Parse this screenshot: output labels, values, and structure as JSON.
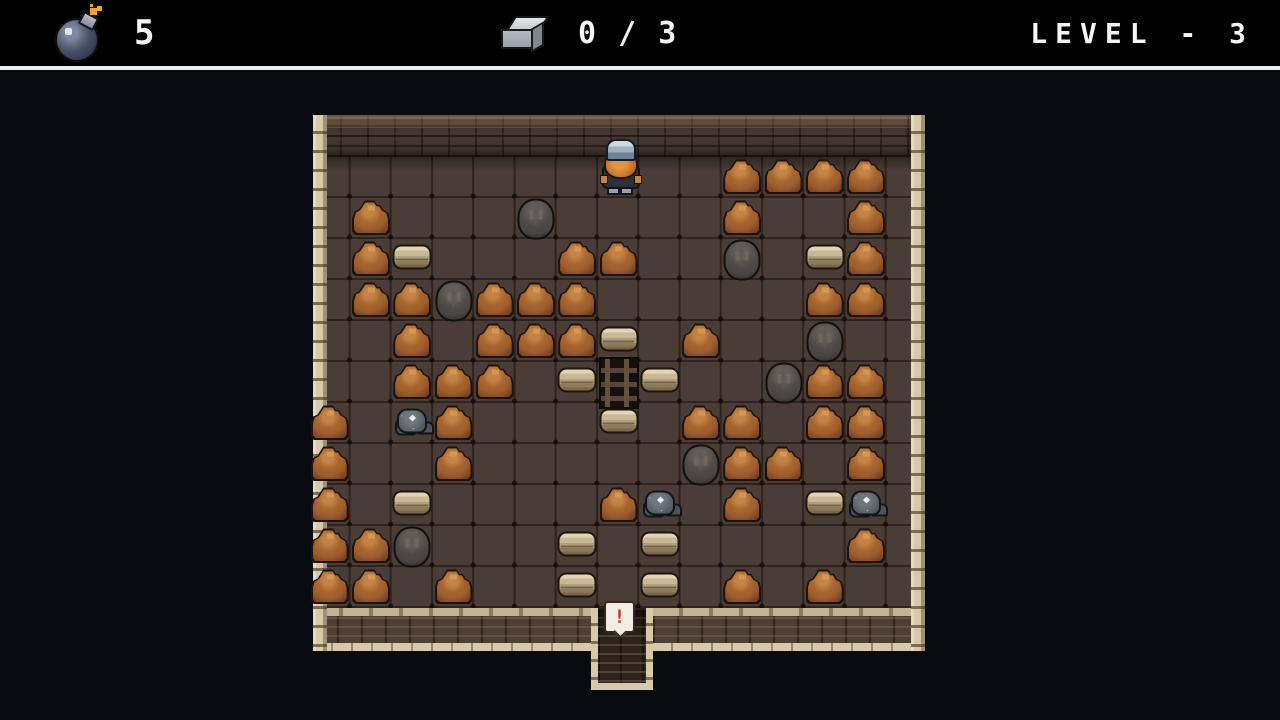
{
  "hud": {
    "bomb_count": "5",
    "bomb_icon": "bomb-icon",
    "ore_progress": "0 / 3",
    "ore_icon": "metal-ingot-icon",
    "level_label": "LEVEL - 3"
  },
  "board": {
    "legend": {
      ".": "empty",
      "M": "dirt-mound",
      "B": "boulder",
      "S": "stone-slab",
      "O": "ore-chunk",
      "L": "ladder",
      "P": "player"
    },
    "rows_map": [
      ".......P..MMMM",
      ".M...B....M..M",
      ".MS...MM..B.SM",
      ".MMBMMM.....MM",
      "..M.MMMS.M..B.",
      "..MMM.SLS..BMM",
      "M.OM...S.MM.MM",
      "M..M.....BMM.M",
      "M.S....MO.M.SO",
      "MMB...S.S....M",
      "MM.M..S.S.M.M."
    ],
    "exit": {
      "bubble_text": "!"
    }
  },
  "colors": {
    "page-bg": "#0a0a11",
    "hud-bg": "#000000",
    "hud-text": "#f5f5f5",
    "wall-tan": "#d8caa8",
    "floor": "#4a3c37",
    "mound": "#9c5c2e",
    "mound-light": "#c58447",
    "boulder": "#4a4542",
    "slab": "#c9b795",
    "ore": "#5c656b",
    "spark": "#f6a23a",
    "alert-red": "#c23a2b",
    "helm-steel": "#9fb2c2",
    "beard-orange": "#c9782e"
  }
}
